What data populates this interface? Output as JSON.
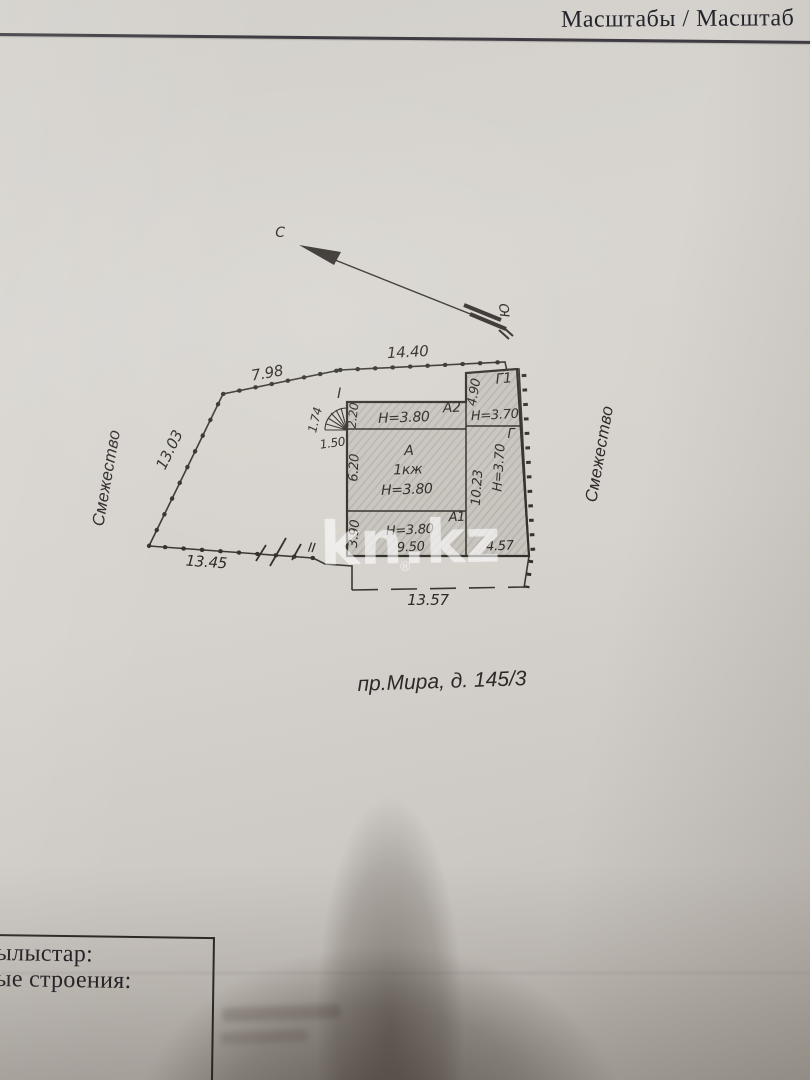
{
  "header": {
    "scale_label": "Масштабы / Масштаб"
  },
  "compass": {
    "north": "С",
    "south": "Ю"
  },
  "adjacency": {
    "left": "Смежество",
    "right": "Смежество"
  },
  "address_label": "пр.Мира, д. 145/3",
  "site": {
    "dim_edge_nw": "7.98",
    "dim_edge_n": "14.40",
    "dim_edge_w": "13.03",
    "dim_edge_sw": "13.45",
    "dim_edge_s": "13.57",
    "fence_mark": "II"
  },
  "stairs": {
    "mark": "I",
    "dim_width": "1.74",
    "dim_depth": "1.50"
  },
  "rooms": {
    "a2": {
      "name": "A2",
      "height": "H=3.80",
      "dim_left": "2.20"
    },
    "g1": {
      "name": "Г1",
      "height": "H=3.70",
      "dim_left": "4.90"
    },
    "a": {
      "name": "A",
      "floor": "1кж",
      "height": "H=3.80",
      "dim_left": "6.20"
    },
    "g": {
      "name": "Г",
      "height": "H=3.70",
      "dim_left": "10.23",
      "dim_bottom": "4.57"
    },
    "a1": {
      "name": "A1",
      "height": "H=3.80",
      "dim_left": "3.90",
      "dim_bottom": "9.50"
    }
  },
  "watermark": {
    "brand": "kn.kz",
    "registered": "®"
  },
  "footer_box": {
    "line1": "ылыстар:",
    "line2": "ые строения:"
  }
}
